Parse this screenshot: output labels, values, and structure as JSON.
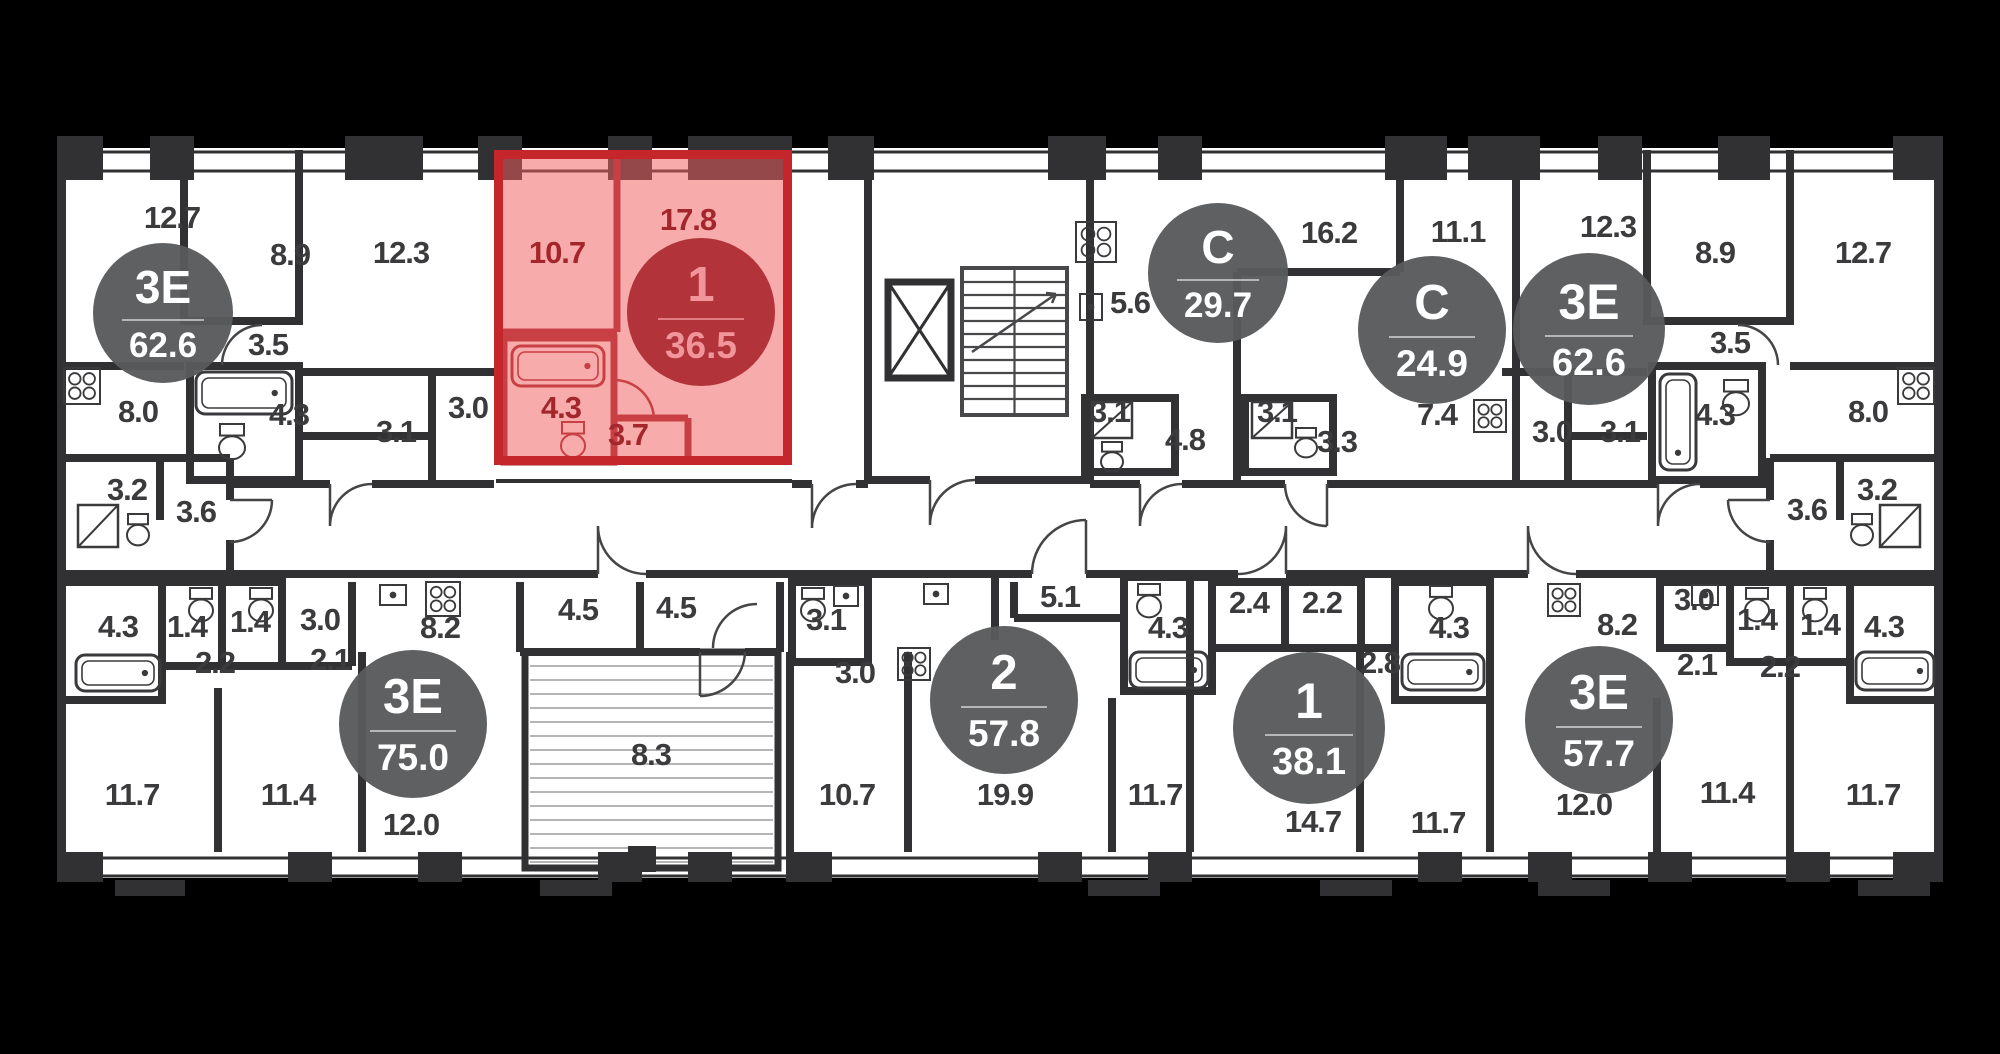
{
  "plan_title": "Residential floor plan with 9 apartments, one highlighted",
  "colors": {
    "background": "#000000",
    "floor": "#ffffff",
    "walls": "#313133",
    "label_text": "#3b3b3d",
    "badge_grey": "#58595b",
    "badge_text": "#ffffff",
    "highlight_fill": "#f15d5d",
    "highlight_border": "#c5262c",
    "highlight_badge": "#b2343a",
    "highlight_label_text": "#a3262c"
  },
  "highlighted_unit": {
    "type": "1",
    "total_area": "36.5"
  },
  "units": [
    {
      "id": "unit-3e-62-left",
      "type": "3Е",
      "total_area": "62.6",
      "variant": "grey",
      "badge": {
        "x": 163,
        "y": 313,
        "r": 70
      },
      "rooms": [
        {
          "a": "12.7",
          "x": 172,
          "y": 218
        },
        {
          "a": "8.9",
          "x": 290,
          "y": 255
        },
        {
          "a": "12.3",
          "x": 401,
          "y": 253
        },
        {
          "a": "3.5",
          "x": 268,
          "y": 345
        },
        {
          "a": "8.0",
          "x": 138,
          "y": 412
        },
        {
          "a": "4.3",
          "x": 289,
          "y": 415
        },
        {
          "a": "3.0",
          "x": 468,
          "y": 408
        },
        {
          "a": "3.1",
          "x": 396,
          "y": 432
        },
        {
          "a": "3.2",
          "x": 127,
          "y": 490
        },
        {
          "a": "3.6",
          "x": 196,
          "y": 512
        }
      ]
    },
    {
      "id": "unit-1-36",
      "type": "1",
      "total_area": "36.5",
      "variant": "red",
      "badge": {
        "x": 701,
        "y": 312,
        "r": 74
      },
      "rooms": [
        {
          "a": "10.7",
          "x": 557,
          "y": 253
        },
        {
          "a": "17.8",
          "x": 688,
          "y": 220
        },
        {
          "a": "4.3",
          "x": 561,
          "y": 408
        },
        {
          "a": "3.7",
          "x": 628,
          "y": 435
        }
      ]
    },
    {
      "id": "unit-s-29",
      "type": "С",
      "total_area": "29.7",
      "variant": "grey",
      "badge": {
        "x": 1218,
        "y": 273,
        "r": 70
      },
      "rooms": [
        {
          "a": "5.6",
          "x": 1130,
          "y": 303
        },
        {
          "a": "16.2",
          "x": 1329,
          "y": 233
        },
        {
          "a": "3.1",
          "x": 1110,
          "y": 412
        },
        {
          "a": "4.8",
          "x": 1185,
          "y": 440
        }
      ]
    },
    {
      "id": "unit-s-24",
      "type": "С",
      "total_area": "24.9",
      "variant": "grey",
      "badge": {
        "x": 1432,
        "y": 330,
        "r": 74
      },
      "rooms": [
        {
          "a": "11.1",
          "x": 1458,
          "y": 232
        },
        {
          "a": "7.4",
          "x": 1437,
          "y": 415
        },
        {
          "a": "3.1",
          "x": 1277,
          "y": 412
        },
        {
          "a": "3.3",
          "x": 1337,
          "y": 442
        }
      ]
    },
    {
      "id": "unit-3e-62-right",
      "type": "3Е",
      "total_area": "62.6",
      "variant": "grey",
      "badge": {
        "x": 1589,
        "y": 329,
        "r": 76
      },
      "rooms": [
        {
          "a": "12.3",
          "x": 1608,
          "y": 227
        },
        {
          "a": "8.9",
          "x": 1715,
          "y": 253
        },
        {
          "a": "12.7",
          "x": 1863,
          "y": 253
        },
        {
          "a": "3.0",
          "x": 1552,
          "y": 432
        },
        {
          "a": "3.1",
          "x": 1620,
          "y": 432
        },
        {
          "a": "3.5",
          "x": 1730,
          "y": 343
        },
        {
          "a": "4.3",
          "x": 1715,
          "y": 415
        },
        {
          "a": "8.0",
          "x": 1868,
          "y": 412
        },
        {
          "a": "3.2",
          "x": 1877,
          "y": 490
        },
        {
          "a": "3.6",
          "x": 1807,
          "y": 510
        }
      ]
    },
    {
      "id": "unit-3e-75",
      "type": "3Е",
      "total_area": "75.0",
      "variant": "grey",
      "badge": {
        "x": 413,
        "y": 724,
        "r": 74
      },
      "rooms": [
        {
          "a": "4.3",
          "x": 118,
          "y": 627
        },
        {
          "a": "1.4",
          "x": 187,
          "y": 627
        },
        {
          "a": "1.4",
          "x": 250,
          "y": 622
        },
        {
          "a": "3.0",
          "x": 320,
          "y": 620
        },
        {
          "a": "2.2",
          "x": 215,
          "y": 663
        },
        {
          "a": "2.1",
          "x": 330,
          "y": 660
        },
        {
          "a": "8.2",
          "x": 440,
          "y": 628
        },
        {
          "a": "4.5",
          "x": 578,
          "y": 610
        },
        {
          "a": "11.7",
          "x": 132,
          "y": 795
        },
        {
          "a": "11.4",
          "x": 288,
          "y": 795
        },
        {
          "a": "12.0",
          "x": 411,
          "y": 825
        },
        {
          "a": "8.3",
          "x": 651,
          "y": 755
        }
      ]
    },
    {
      "id": "unit-2-57",
      "type": "2",
      "total_area": "57.8",
      "variant": "grey",
      "badge": {
        "x": 1004,
        "y": 700,
        "r": 74
      },
      "rooms": [
        {
          "a": "4.5",
          "x": 676,
          "y": 608
        },
        {
          "a": "3.1",
          "x": 826,
          "y": 620
        },
        {
          "a": "3.0",
          "x": 855,
          "y": 673
        },
        {
          "a": "5.1",
          "x": 1060,
          "y": 597
        },
        {
          "a": "4.3",
          "x": 1168,
          "y": 628
        },
        {
          "a": "10.7",
          "x": 847,
          "y": 795
        },
        {
          "a": "19.9",
          "x": 1005,
          "y": 795
        },
        {
          "a": "11.7",
          "x": 1155,
          "y": 795
        }
      ]
    },
    {
      "id": "unit-1-38",
      "type": "1",
      "total_area": "38.1",
      "variant": "grey",
      "badge": {
        "x": 1309,
        "y": 728,
        "r": 76
      },
      "rooms": [
        {
          "a": "2.4",
          "x": 1249,
          "y": 603
        },
        {
          "a": "2.2",
          "x": 1322,
          "y": 603
        },
        {
          "a": "4.3",
          "x": 1449,
          "y": 628
        },
        {
          "a": "2.8",
          "x": 1380,
          "y": 663
        },
        {
          "a": "14.7",
          "x": 1313,
          "y": 822
        },
        {
          "a": "11.7",
          "x": 1438,
          "y": 823
        }
      ]
    },
    {
      "id": "unit-3e-57",
      "type": "3Е",
      "total_area": "57.7",
      "variant": "grey",
      "badge": {
        "x": 1599,
        "y": 720,
        "r": 74
      },
      "rooms": [
        {
          "a": "8.2",
          "x": 1617,
          "y": 625
        },
        {
          "a": "3.0",
          "x": 1694,
          "y": 600
        },
        {
          "a": "1.4",
          "x": 1757,
          "y": 620
        },
        {
          "a": "1.4",
          "x": 1820,
          "y": 625
        },
        {
          "a": "4.3",
          "x": 1884,
          "y": 627
        },
        {
          "a": "2.1",
          "x": 1697,
          "y": 665
        },
        {
          "a": "2.2",
          "x": 1780,
          "y": 667
        },
        {
          "a": "12.0",
          "x": 1584,
          "y": 805
        },
        {
          "a": "11.4",
          "x": 1727,
          "y": 793
        },
        {
          "a": "11.7",
          "x": 1873,
          "y": 795
        }
      ]
    },
    {
      "id": "core",
      "type": "",
      "total_area": "",
      "variant": "none",
      "badge": null,
      "rooms": []
    }
  ],
  "fixtures": [
    {
      "icon": "bathtub-icon",
      "x": 196,
      "y": 372,
      "w": 96,
      "h": 42
    },
    {
      "icon": "toilet-icon",
      "x": 218,
      "y": 424,
      "w": 28,
      "h": 36
    },
    {
      "icon": "stove-icon",
      "x": 64,
      "y": 368,
      "w": 36,
      "h": 36
    },
    {
      "icon": "washer-icon",
      "x": 78,
      "y": 505,
      "w": 40,
      "h": 42
    },
    {
      "icon": "toilet-icon",
      "x": 126,
      "y": 514,
      "w": 24,
      "h": 32
    },
    {
      "icon": "bathtub-icon",
      "x": 512,
      "y": 346,
      "w": 92,
      "h": 40,
      "c": "#9c2026"
    },
    {
      "icon": "toilet-icon",
      "x": 560,
      "y": 422,
      "w": 26,
      "h": 36,
      "c": "#9c2026"
    },
    {
      "icon": "stove-icon",
      "x": 1076,
      "y": 222,
      "w": 40,
      "h": 40
    },
    {
      "icon": "sink-icon",
      "x": 1080,
      "y": 294,
      "w": 22,
      "h": 26
    },
    {
      "icon": "washer-icon",
      "x": 1092,
      "y": 402,
      "w": 40,
      "h": 36
    },
    {
      "icon": "toilet-icon",
      "x": 1100,
      "y": 442,
      "w": 24,
      "h": 30
    },
    {
      "icon": "washer-icon",
      "x": 1252,
      "y": 402,
      "w": 40,
      "h": 36
    },
    {
      "icon": "toilet-icon",
      "x": 1294,
      "y": 428,
      "w": 24,
      "h": 30
    },
    {
      "icon": "stove-icon",
      "x": 1474,
      "y": 400,
      "w": 32,
      "h": 32
    },
    {
      "icon": "bathtub-icon",
      "x": 1660,
      "y": 374,
      "w": 36,
      "h": 96
    },
    {
      "icon": "toilet-icon",
      "x": 1722,
      "y": 380,
      "w": 28,
      "h": 36
    },
    {
      "icon": "stove-icon",
      "x": 1898,
      "y": 368,
      "w": 36,
      "h": 36
    },
    {
      "icon": "washer-icon",
      "x": 1880,
      "y": 505,
      "w": 40,
      "h": 42
    },
    {
      "icon": "toilet-icon",
      "x": 1850,
      "y": 514,
      "w": 24,
      "h": 32
    },
    {
      "icon": "bathtub-icon",
      "x": 76,
      "y": 655,
      "w": 84,
      "h": 36
    },
    {
      "icon": "toilet-icon",
      "x": 188,
      "y": 588,
      "w": 26,
      "h": 34
    },
    {
      "icon": "toilet-icon",
      "x": 248,
      "y": 588,
      "w": 26,
      "h": 34
    },
    {
      "icon": "sink-icon",
      "x": 380,
      "y": 585,
      "w": 26,
      "h": 20
    },
    {
      "icon": "stove-icon",
      "x": 426,
      "y": 582,
      "w": 34,
      "h": 34
    },
    {
      "icon": "toilet-icon",
      "x": 800,
      "y": 588,
      "w": 26,
      "h": 34
    },
    {
      "icon": "sink-icon",
      "x": 834,
      "y": 586,
      "w": 24,
      "h": 20
    },
    {
      "icon": "stove-icon",
      "x": 898,
      "y": 648,
      "w": 32,
      "h": 32
    },
    {
      "icon": "sink-icon",
      "x": 924,
      "y": 584,
      "w": 24,
      "h": 20
    },
    {
      "icon": "bathtub-icon",
      "x": 1130,
      "y": 652,
      "w": 78,
      "h": 36
    },
    {
      "icon": "toilet-icon",
      "x": 1136,
      "y": 584,
      "w": 26,
      "h": 34
    },
    {
      "icon": "toilet-icon",
      "x": 1428,
      "y": 586,
      "w": 26,
      "h": 34
    },
    {
      "icon": "bathtub-icon",
      "x": 1402,
      "y": 654,
      "w": 82,
      "h": 36
    },
    {
      "icon": "stove-icon",
      "x": 1548,
      "y": 584,
      "w": 32,
      "h": 32
    },
    {
      "icon": "sink-icon",
      "x": 1692,
      "y": 585,
      "w": 26,
      "h": 20
    },
    {
      "icon": "toilet-icon",
      "x": 1744,
      "y": 588,
      "w": 26,
      "h": 34
    },
    {
      "icon": "toilet-icon",
      "x": 1802,
      "y": 588,
      "w": 26,
      "h": 34
    },
    {
      "icon": "bathtub-icon",
      "x": 1856,
      "y": 652,
      "w": 78,
      "h": 38
    }
  ]
}
